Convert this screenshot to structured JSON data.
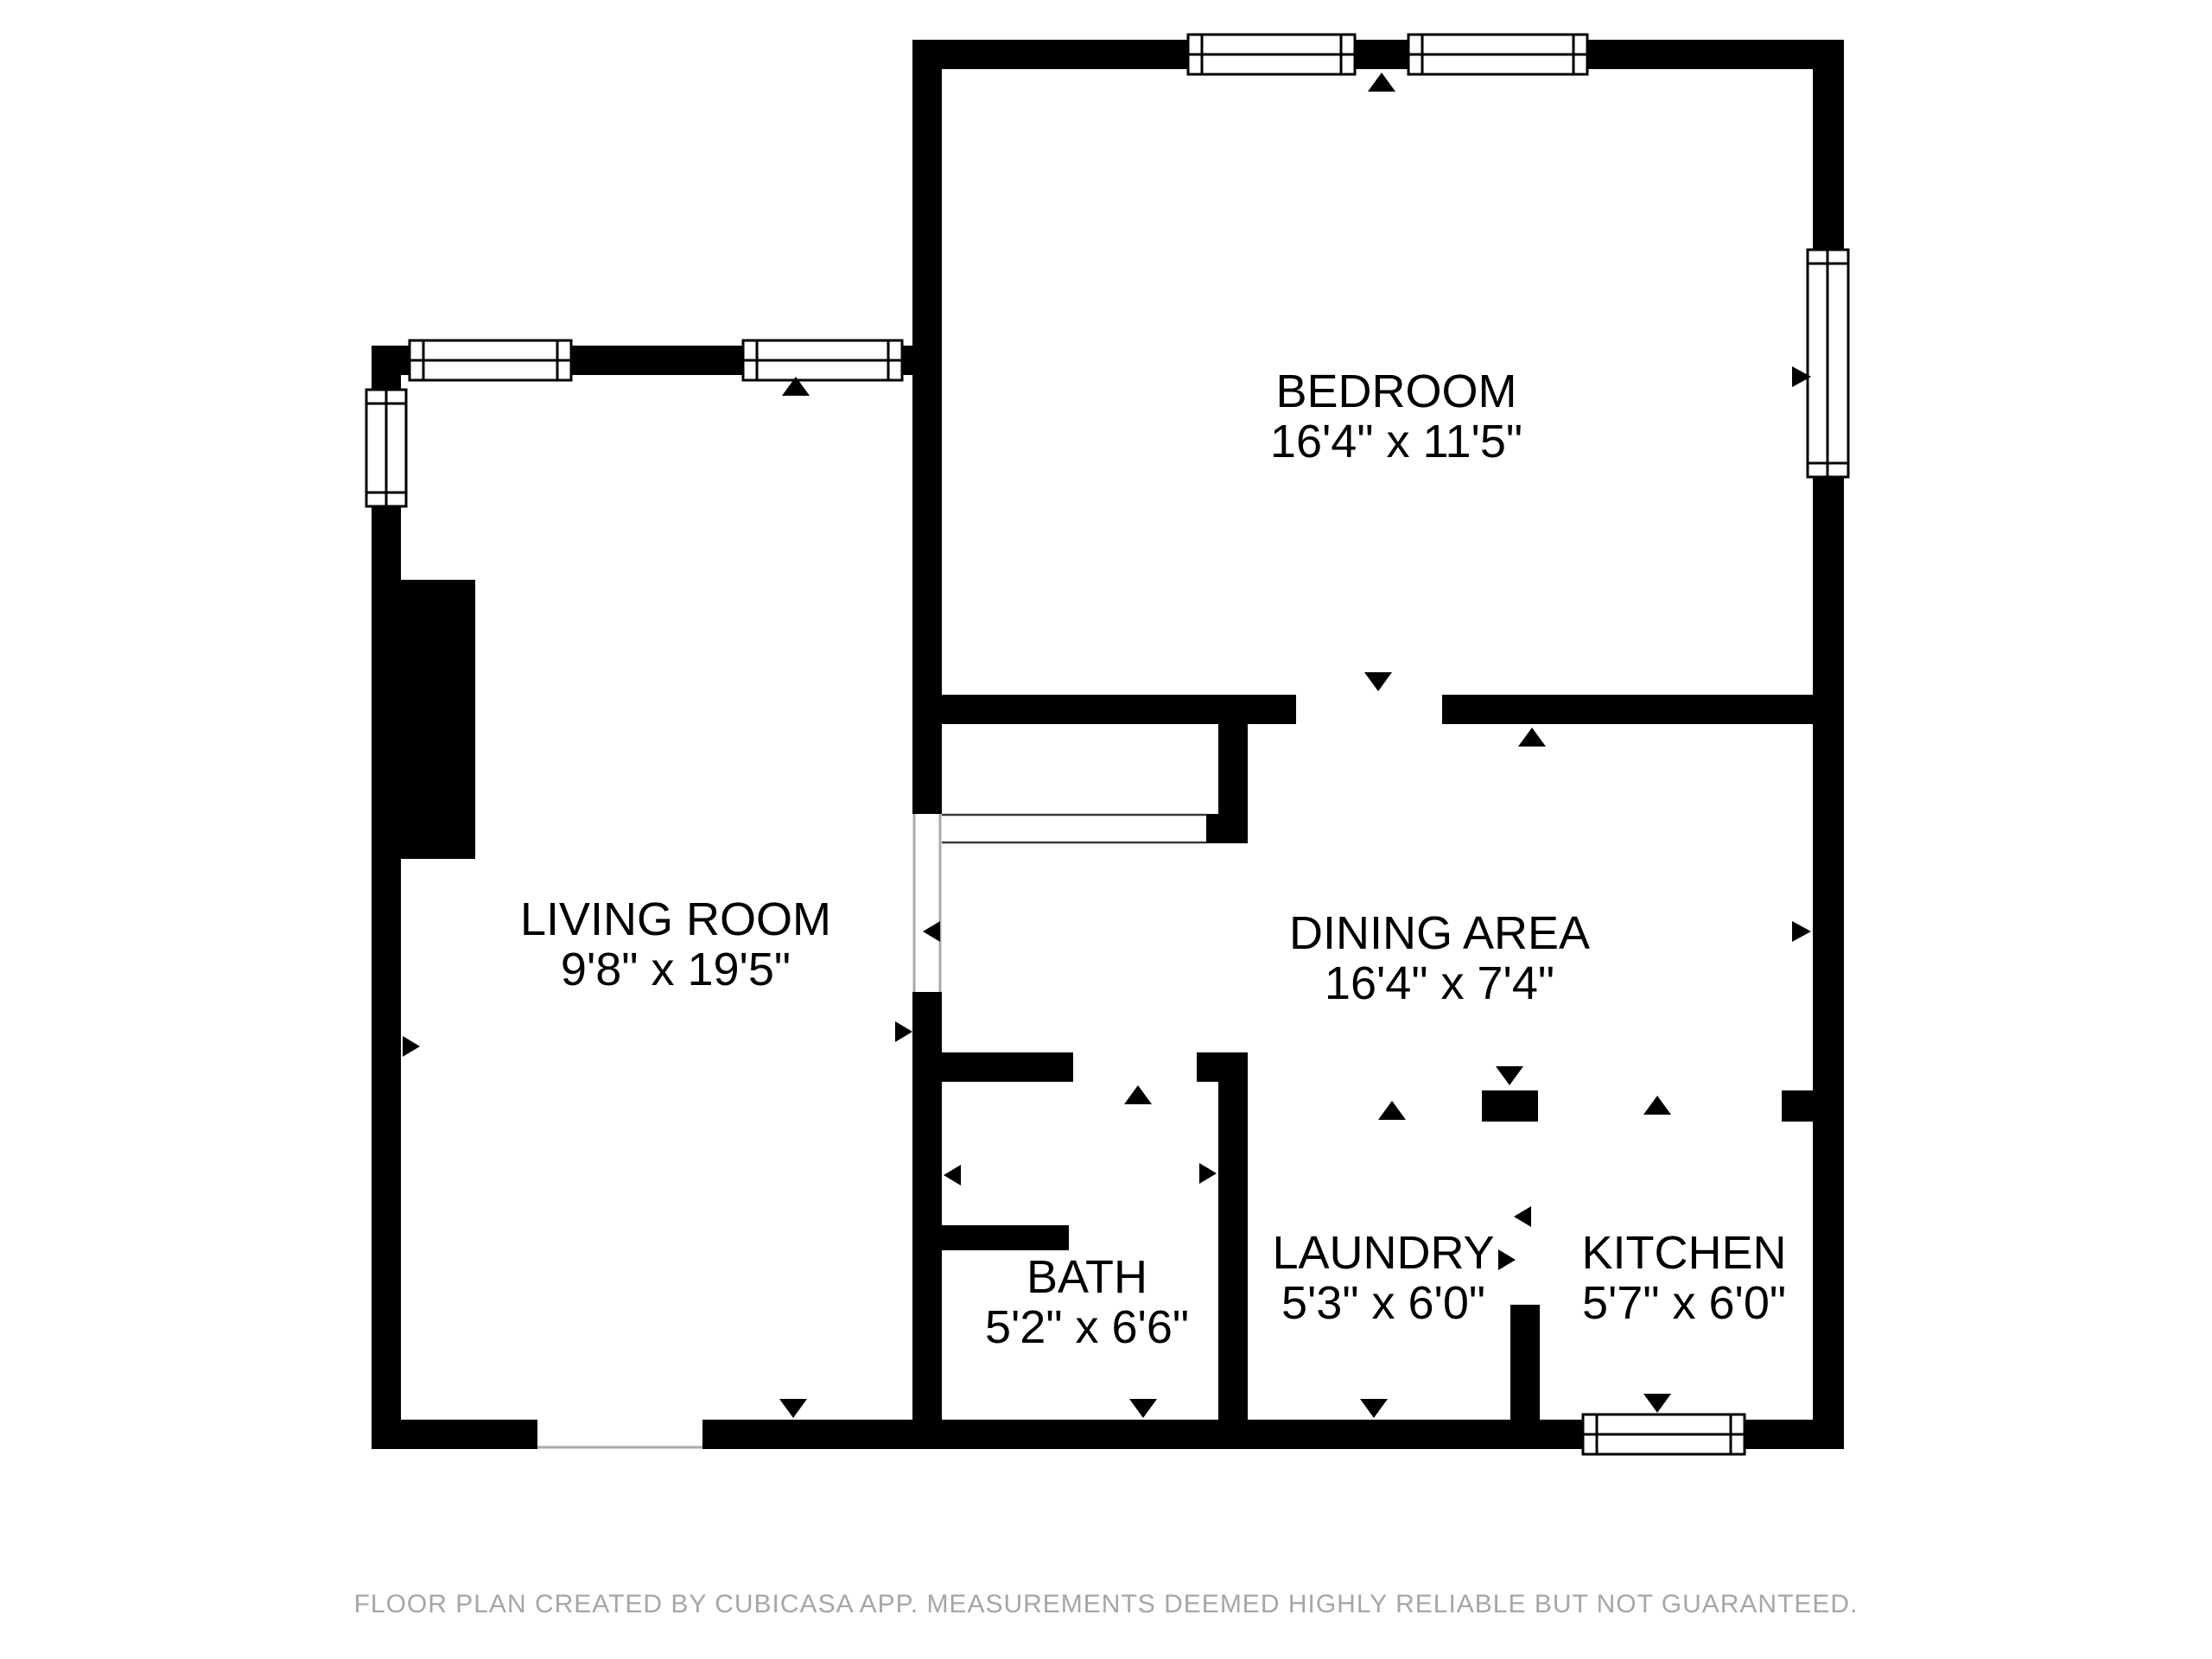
{
  "page": {
    "background": "#ffffff"
  },
  "plan": {
    "wall_color": "#000000",
    "opening_line_color": "#a9a9a9",
    "rooms": [
      {
        "name": "BEDROOM",
        "dimensions": "16'4\" x 11'5\""
      },
      {
        "name": "LIVING ROOM",
        "dimensions": "9'8\" x 19'5\""
      },
      {
        "name": "DINING AREA",
        "dimensions": "16'4\" x 7'4\""
      },
      {
        "name": "BATH",
        "dimensions": "5'2\" x 6'6\""
      },
      {
        "name": "LAUNDRY",
        "dimensions": "5'3\" x 6'0\""
      },
      {
        "name": "KITCHEN",
        "dimensions": "5'7\" x 6'0\""
      }
    ]
  },
  "footer": {
    "disclaimer": "FLOOR PLAN CREATED BY CUBICASA APP. MEASUREMENTS DEEMED HIGHLY RELIABLE BUT NOT GUARANTEED.",
    "color": "#a6a6a6"
  }
}
